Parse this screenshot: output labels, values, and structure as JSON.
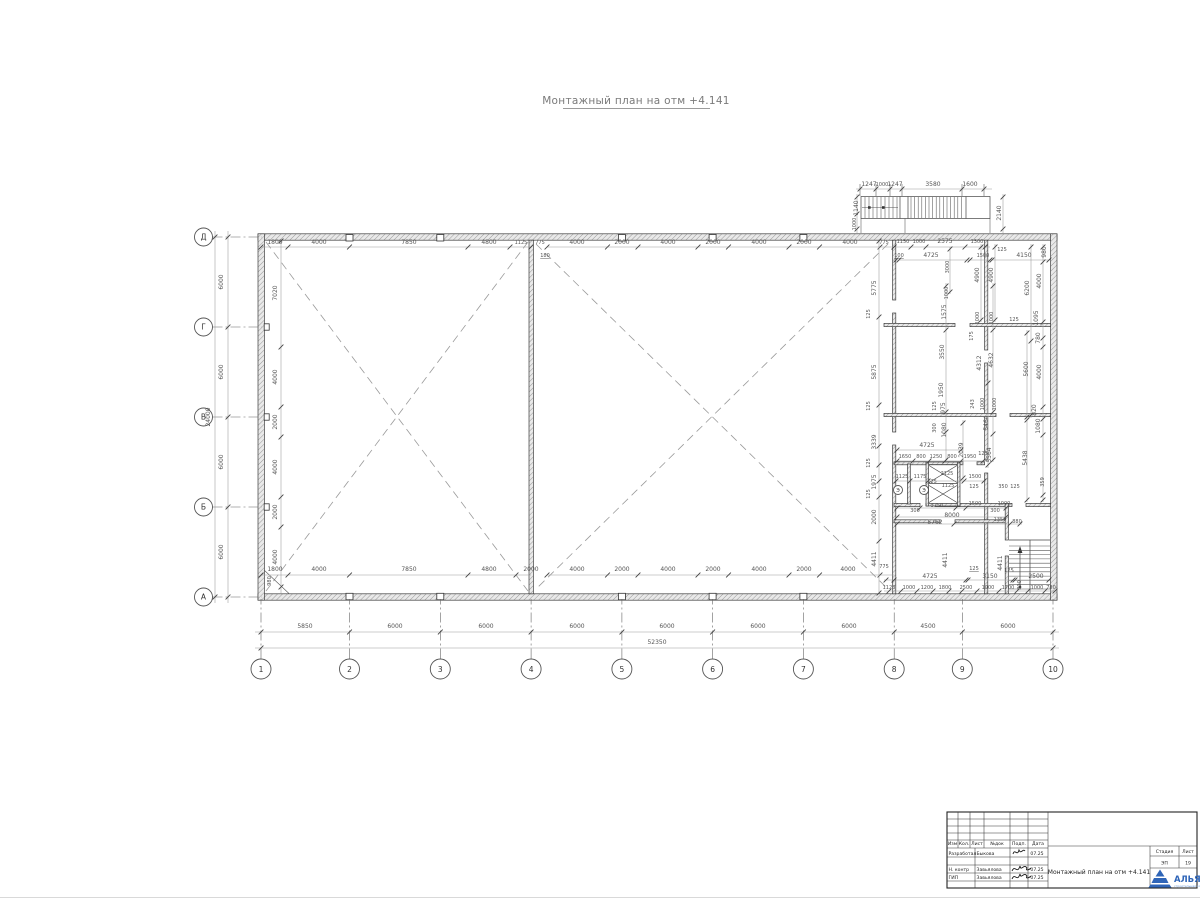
{
  "title": "Монтажный план на отм +4.141",
  "colors": {
    "line": "#3c3c3c",
    "dim_text": "#555555",
    "accent_blue": "#2f65b8"
  },
  "axes": {
    "cols": [
      {
        "label": "1",
        "x": 261
      },
      {
        "label": "2",
        "x": 349.5
      },
      {
        "label": "3",
        "x": 440.3
      },
      {
        "label": "4",
        "x": 531.1
      },
      {
        "label": "5",
        "x": 621.9
      },
      {
        "label": "6",
        "x": 712.6
      },
      {
        "label": "7",
        "x": 803.4
      },
      {
        "label": "8",
        "x": 894.2
      },
      {
        "label": "9",
        "x": 962.3
      },
      {
        "label": "10",
        "x": 1053
      }
    ],
    "rows": [
      {
        "label": "Д",
        "y": 237
      },
      {
        "label": "Г",
        "y": 327
      },
      {
        "label": "В",
        "y": 417
      },
      {
        "label": "Б",
        "y": 507
      },
      {
        "label": "А",
        "y": 597
      }
    ]
  },
  "equip_marks": [
    {
      "label": "Э",
      "x": 898,
      "y": 490
    },
    {
      "label": "Э",
      "x": 924,
      "y": 490
    }
  ],
  "dim_lines": {
    "h": [
      [
        632,
        255,
        1059,
        [
          261,
          349.5,
          440.3,
          531.1,
          621.9,
          712.6,
          803.4,
          894.2,
          962.3,
          1053
        ]
      ],
      [
        648,
        255,
        1059,
        [
          261,
          1053
        ]
      ],
      [
        247,
        261,
        531,
        [
          261,
          288,
          349.5,
          468,
          510,
          531
        ]
      ],
      [
        247,
        547,
        894,
        [
          547,
          607.5,
          638,
          698,
          728.5,
          789,
          819.5,
          880,
          894
        ]
      ],
      [
        247,
        894,
        990,
        [
          894,
          911,
          926,
          965,
          985
        ]
      ],
      [
        260,
        894,
        1051,
        [
          896,
          899,
          967,
          970,
          990,
          992,
          1049
        ]
      ],
      [
        189,
        856,
        992,
        [
          860,
          876,
          890,
          902,
          962,
          984
        ]
      ],
      [
        461,
        896,
        986,
        [
          897,
          913,
          929,
          945,
          961,
          983
        ]
      ],
      [
        481,
        896,
        986,
        [
          896,
          910,
          928,
          964,
          984
        ]
      ],
      [
        450,
        896,
        963,
        [
          897,
          961
        ]
      ],
      [
        508,
        896,
        1008,
        [
          897,
          920,
          956,
          966,
          1006
        ]
      ],
      [
        517,
        896,
        1008,
        [
          897,
          1006
        ]
      ],
      [
        524,
        896,
        1022,
        [
          897,
          954,
          1010,
          1020
        ]
      ],
      [
        575,
        261,
        531,
        [
          261,
          288,
          349.5,
          468,
          516
        ]
      ],
      [
        575,
        547,
        894,
        [
          547,
          607.5,
          638,
          698,
          728.5,
          789,
          819.5,
          880
        ]
      ],
      [
        580,
        884,
        1051,
        [
          886,
          894,
          966,
          968,
          1013,
          1015,
          1049
        ]
      ],
      [
        591,
        884,
        1057,
        [
          889,
          901,
          917,
          933,
          949,
          962,
          977,
          999,
          1017,
          1028,
          1045,
          1055
        ]
      ]
    ],
    "v": [
      [
        228,
        231,
        603,
        [
          237,
          327,
          417,
          507,
          597
        ]
      ],
      [
        215,
        231,
        603,
        [
          237,
          597
        ]
      ],
      [
        281,
        241,
        593,
        [
          241,
          347,
          407,
          437,
          497,
          527,
          587
        ]
      ],
      [
        879,
        241,
        593,
        [
          241,
          317,
          405,
          446,
          465,
          481,
          497,
          541,
          593
        ]
      ],
      [
        857,
        194,
        233,
        [
          197,
          214,
          229
        ]
      ],
      [
        1003,
        194,
        233,
        [
          197,
          229
        ]
      ],
      [
        981,
        244,
        322,
        [
          247,
          320
        ]
      ],
      [
        995,
        244,
        322,
        [
          247,
          320
        ]
      ],
      [
        1031,
        244,
        418,
        [
          247,
          341,
          415
        ]
      ],
      [
        1043,
        244,
        502,
        [
          247,
          262,
          322,
          338,
          347,
          407,
          419,
          435,
          495,
          500
        ]
      ],
      [
        950,
        247,
        294,
        [
          249,
          292
        ]
      ],
      [
        946,
        283,
        462,
        [
          286,
          330,
          412,
          432,
          460
        ]
      ],
      [
        993,
        283,
        462,
        [
          286,
          330,
          412,
          434,
          460
        ]
      ],
      [
        1027,
        330,
        502,
        [
          333,
          417,
          420,
          500
        ]
      ],
      [
        988,
        380,
        468,
        [
          383,
          465
        ]
      ],
      [
        963,
        420,
        480,
        [
          423,
          478
        ]
      ]
    ]
  },
  "labels": [
    [
      "5850",
      305,
      628
    ],
    [
      "6000",
      395,
      628
    ],
    [
      "6000",
      486,
      628
    ],
    [
      "6000",
      577,
      628
    ],
    [
      "6000",
      667,
      628
    ],
    [
      "6000",
      758,
      628
    ],
    [
      "6000",
      849,
      628
    ],
    [
      "4500",
      928,
      628
    ],
    [
      "6000",
      1008,
      628
    ],
    [
      "52350",
      657,
      644
    ],
    [
      "6000",
      223,
      282,
      "r"
    ],
    [
      "6000",
      223,
      372,
      "r"
    ],
    [
      "6000",
      223,
      462,
      "r"
    ],
    [
      "6000",
      223,
      552,
      "r"
    ],
    [
      "24000",
      210,
      417,
      "r"
    ],
    [
      "1800",
      275,
      244
    ],
    [
      "4000",
      319,
      244
    ],
    [
      "7850",
      409,
      244
    ],
    [
      "4800",
      489,
      244
    ],
    [
      "1125",
      521,
      244,
      "s"
    ],
    [
      "775",
      540,
      244,
      "s"
    ],
    [
      "180",
      545,
      257,
      "su"
    ],
    [
      "4000",
      577,
      244
    ],
    [
      "2000",
      622,
      244
    ],
    [
      "4000",
      668,
      244
    ],
    [
      "2000",
      713,
      244
    ],
    [
      "4000",
      759,
      244
    ],
    [
      "2000",
      804,
      244
    ],
    [
      "4000",
      850,
      244
    ],
    [
      "775",
      884,
      244,
      "s"
    ],
    [
      "1150",
      903,
      243,
      "s"
    ],
    [
      "1000",
      919,
      243,
      "s"
    ],
    [
      "2575",
      945,
      243
    ],
    [
      "1300",
      977,
      243,
      "s"
    ],
    [
      "100",
      899,
      257,
      "su"
    ],
    [
      "4725",
      931,
      257
    ],
    [
      "1500",
      983,
      257,
      "s"
    ],
    [
      "125",
      1002,
      251,
      "s"
    ],
    [
      "4150",
      1024,
      257
    ],
    [
      "3000",
      949,
      267,
      "rs"
    ],
    [
      "980",
      1046,
      252,
      "r"
    ],
    [
      "1247",
      869,
      186
    ],
    [
      "1000",
      882,
      186,
      "s"
    ],
    [
      "1247",
      895,
      186
    ],
    [
      "3580",
      933,
      186
    ],
    [
      "1600",
      970,
      186
    ],
    [
      "1140",
      858,
      208,
      "r"
    ],
    [
      "1000",
      856,
      224,
      "rs"
    ],
    [
      "2140",
      1001,
      213,
      "r"
    ],
    [
      "7020",
      277,
      293,
      "r"
    ],
    [
      "4000",
      277,
      377,
      "r"
    ],
    [
      "2000",
      277,
      422,
      "r"
    ],
    [
      "4000",
      277,
      467,
      "r"
    ],
    [
      "2000",
      277,
      512,
      "r"
    ],
    [
      "4000",
      277,
      557,
      "r"
    ],
    [
      "5775",
      876,
      288,
      "r"
    ],
    [
      "125",
      870,
      314,
      "rs"
    ],
    [
      "5875",
      876,
      372,
      "r"
    ],
    [
      "125",
      870,
      406,
      "rs"
    ],
    [
      "3339",
      876,
      442,
      "r"
    ],
    [
      "125",
      870,
      463,
      "rs"
    ],
    [
      "1975",
      876,
      482,
      "r"
    ],
    [
      "125",
      870,
      494,
      "rs"
    ],
    [
      "2000",
      876,
      517,
      "r"
    ],
    [
      "4411",
      876,
      559,
      "r"
    ],
    [
      "4900",
      979,
      275,
      "r"
    ],
    [
      "4900",
      993,
      275,
      "r"
    ],
    [
      "6200",
      1029,
      288,
      "r"
    ],
    [
      "4000",
      1041,
      281,
      "r"
    ],
    [
      "1000",
      948,
      293,
      "rs"
    ],
    [
      "1575",
      946,
      312,
      "r"
    ],
    [
      "1000",
      979,
      318,
      "rs"
    ],
    [
      "1000",
      993,
      318,
      "rs"
    ],
    [
      "125",
      1014,
      321,
      "s"
    ],
    [
      "1095",
      1038,
      318,
      "r"
    ],
    [
      "780",
      1040,
      338,
      "r"
    ],
    [
      "175",
      973,
      336,
      "rs"
    ],
    [
      "3550",
      944,
      352,
      "r"
    ],
    [
      "4312",
      981,
      363,
      "r"
    ],
    [
      "4632",
      993,
      360,
      "r"
    ],
    [
      "5600",
      1028,
      369,
      "r"
    ],
    [
      "4000",
      1041,
      372,
      "r"
    ],
    [
      "1950",
      943,
      390,
      "r"
    ],
    [
      "125",
      936,
      406,
      "rs"
    ],
    [
      "975",
      945,
      408,
      "r"
    ],
    [
      "243",
      974,
      404,
      "rs"
    ],
    [
      "1000",
      984,
      404,
      "rs"
    ],
    [
      "1000",
      996,
      404,
      "rs"
    ],
    [
      "820",
      1036,
      410,
      "r"
    ],
    [
      "300",
      936,
      428,
      "rs"
    ],
    [
      "1080",
      946,
      430,
      "r"
    ],
    [
      "5464",
      988,
      423,
      "r"
    ],
    [
      "1080",
      1040,
      426,
      "r"
    ],
    [
      "4725",
      927,
      447
    ],
    [
      "2039",
      963,
      450,
      "r"
    ],
    [
      "5564",
      991,
      455,
      "r"
    ],
    [
      "5438",
      1027,
      458,
      "r"
    ],
    [
      "359",
      1044,
      482,
      "rs"
    ],
    [
      "1650",
      905,
      458,
      "s"
    ],
    [
      "800",
      921,
      458,
      "s"
    ],
    [
      "1250",
      936,
      458,
      "s"
    ],
    [
      "800",
      952,
      458,
      "s"
    ],
    [
      "1950",
      970,
      458,
      "s"
    ],
    [
      "125",
      983,
      455,
      "s"
    ],
    [
      "1125",
      902,
      478,
      "s"
    ],
    [
      "1175",
      920,
      478,
      "s"
    ],
    [
      "2125",
      947,
      475,
      "s"
    ],
    [
      "1500",
      975,
      478,
      "s"
    ],
    [
      "125",
      932,
      483,
      "s"
    ],
    [
      "1125",
      948,
      487,
      "s"
    ],
    [
      "125",
      974,
      488,
      "s"
    ],
    [
      "350",
      1003,
      488,
      "s"
    ],
    [
      "125",
      1015,
      488,
      "s"
    ],
    [
      "3750",
      937,
      507,
      "s"
    ],
    [
      "1500",
      975,
      505,
      "s"
    ],
    [
      "1000",
      1004,
      505,
      "s"
    ],
    [
      "300",
      915,
      512,
      "s"
    ],
    [
      "300",
      995,
      512,
      "s"
    ],
    [
      "8000",
      952,
      517
    ],
    [
      "5762",
      935,
      524
    ],
    [
      "1350",
      1000,
      521,
      "s"
    ],
    [
      "880",
      1017,
      523,
      "s"
    ],
    [
      "4411",
      947,
      560,
      "r"
    ],
    [
      "4411",
      1002,
      563,
      "r"
    ],
    [
      "1800",
      275,
      571
    ],
    [
      "4000",
      319,
      571
    ],
    [
      "7850",
      409,
      571
    ],
    [
      "4800",
      489,
      571
    ],
    [
      "2000",
      531,
      571
    ],
    [
      "980",
      271,
      581,
      "rs"
    ],
    [
      "4000",
      577,
      571
    ],
    [
      "2000",
      622,
      571
    ],
    [
      "4000",
      668,
      571
    ],
    [
      "2000",
      713,
      571
    ],
    [
      "4000",
      759,
      571
    ],
    [
      "2000",
      804,
      571
    ],
    [
      "4000",
      848,
      571
    ],
    [
      "775",
      884,
      568,
      "s"
    ],
    [
      "4725",
      930,
      578
    ],
    [
      "125",
      974,
      570,
      "su"
    ],
    [
      "3150",
      990,
      578
    ],
    [
      "125",
      1009,
      572,
      "s"
    ],
    [
      "2500",
      1036,
      578
    ],
    [
      "1123",
      889,
      589,
      "s"
    ],
    [
      "1000",
      909,
      589,
      "s"
    ],
    [
      "1200",
      927,
      589,
      "s"
    ],
    [
      "1800",
      945,
      589,
      "s"
    ],
    [
      "2500",
      966,
      589,
      "s"
    ],
    [
      "1000",
      988,
      589,
      "s"
    ],
    [
      "1700",
      1008,
      589,
      "s"
    ],
    [
      "800",
      1021,
      585,
      "rs"
    ],
    [
      "1000",
      1037,
      589,
      "s"
    ],
    [
      "780",
      1051,
      589,
      "s"
    ]
  ],
  "titleblock": {
    "header": {
      "izm": "Изм",
      "kol": "Кол.",
      "list": "Лист",
      "ndok": "№док",
      "podp": "Подп.",
      "data": "Дата"
    },
    "rows": [
      {
        "role": "Разработал",
        "name": "Быкова",
        "date": "07.25"
      },
      {
        "role": "Н. контр",
        "name": "Завьялова",
        "date": "07.25"
      },
      {
        "role": "ГИП",
        "name": "Завьялова",
        "date": "07.25"
      }
    ],
    "doc_title": "Монтажный план на отм +4.141",
    "stage_label": "Стадия",
    "stage": "ЭП",
    "sheet_label": "Лист",
    "sheet": "19",
    "logo_text": "АЛЬЯ",
    "logo_sub": "строительная компания"
  }
}
